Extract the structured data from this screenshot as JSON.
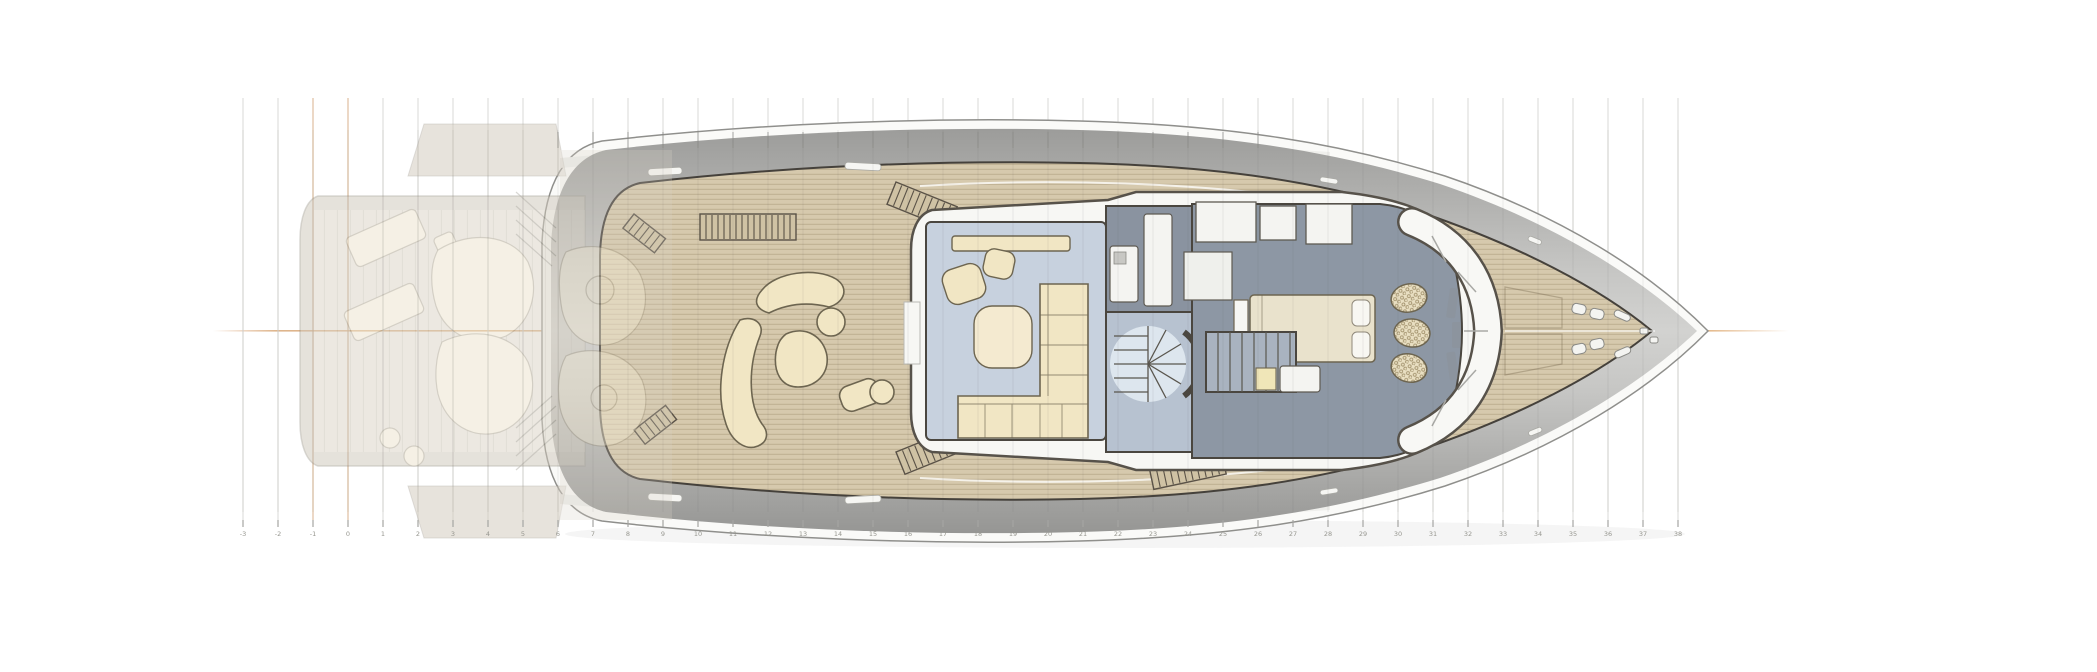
{
  "scene": {
    "subject": "Motor yacht main-deck floor plan, top view, bow pointing right",
    "background": "#ffffff",
    "deck_level": "main deck with ghosted aft swim-platform overlay"
  },
  "grid": {
    "stations": [
      "-3",
      "-2",
      "-1",
      "0",
      "1",
      "2",
      "3",
      "4",
      "5",
      "6",
      "7",
      "8",
      "9",
      "10",
      "11",
      "12",
      "13",
      "14",
      "15",
      "16",
      "17",
      "18",
      "19",
      "20",
      "21",
      "22",
      "23",
      "24",
      "25",
      "26",
      "27",
      "28",
      "29",
      "30",
      "31",
      "32",
      "33",
      "34",
      "35",
      "36",
      "37",
      "38"
    ],
    "highlight_stations": [
      "-1",
      "0"
    ],
    "line_color": "#dadad7",
    "highlight_color": "#d9b28c",
    "tick_color": "#a5a5a2",
    "label_color": "#96968f"
  },
  "centerline": {
    "color": "#d89a68"
  },
  "palette": {
    "teak_deck": "#d6c9ad",
    "teak_grain": "#8c7450",
    "hull_band": "#b0b0ae",
    "hull_rim": "#fafaf8",
    "superstructure_wall": "#f7f7f4",
    "wall_outline": "#57524a",
    "salon_floor": "#c7d1de",
    "corridor_floor": "#b7c2d0",
    "galley_block": "#8a93a0",
    "cabin_floor": "#8d97a4",
    "furniture_cream": "#f1e6c4",
    "furniture_outline": "#6d6550",
    "bed": "#e9e2cc",
    "stair_fan": "#dde6ee",
    "ghost_body": "#d5cec2",
    "ghost_deck": "#dbd4c7",
    "ghost_furniture": "#ece4cf"
  }
}
